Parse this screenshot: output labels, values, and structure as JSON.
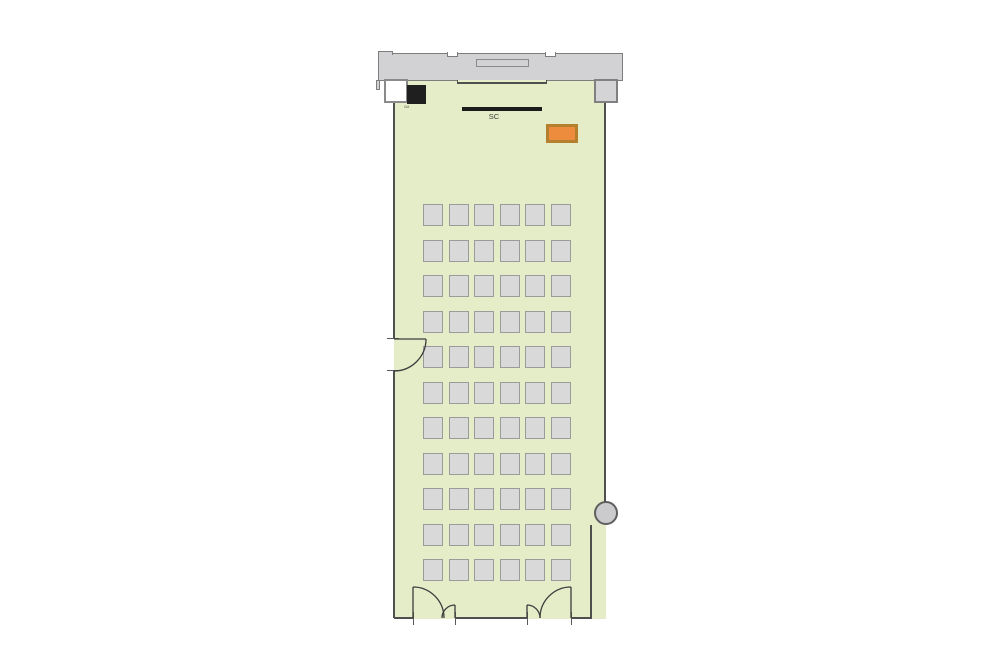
{
  "plan": {
    "type": "room floor plan",
    "screen": {
      "label": "SC"
    },
    "console_label": "i1#",
    "seating": {
      "rows": 11,
      "columns": 6,
      "total_seats": 66,
      "origin_x": 423,
      "origin_y": 204,
      "pitch_x": 25.6,
      "pitch_y": 35.5,
      "seat_w": 20,
      "seat_h": 22
    },
    "colors": {
      "room_fill": "#e4ecc8",
      "seat_fill": "#d9d9d9",
      "seat_border": "#9b9b9b",
      "wall_color": "#4f4f4f",
      "corridor_fill": "#d2d2d4",
      "corridor_border": "#7d7d7d",
      "screen_fill": "#1b1b1b",
      "desk_fill": "#ee8c3e",
      "desk_border": "#b5802e",
      "console_fill": "#1f1f1f",
      "column_fill": "#d4d4d6",
      "circle_fill": "#cbcbcd",
      "door_stroke": "#3d3d3d"
    }
  }
}
